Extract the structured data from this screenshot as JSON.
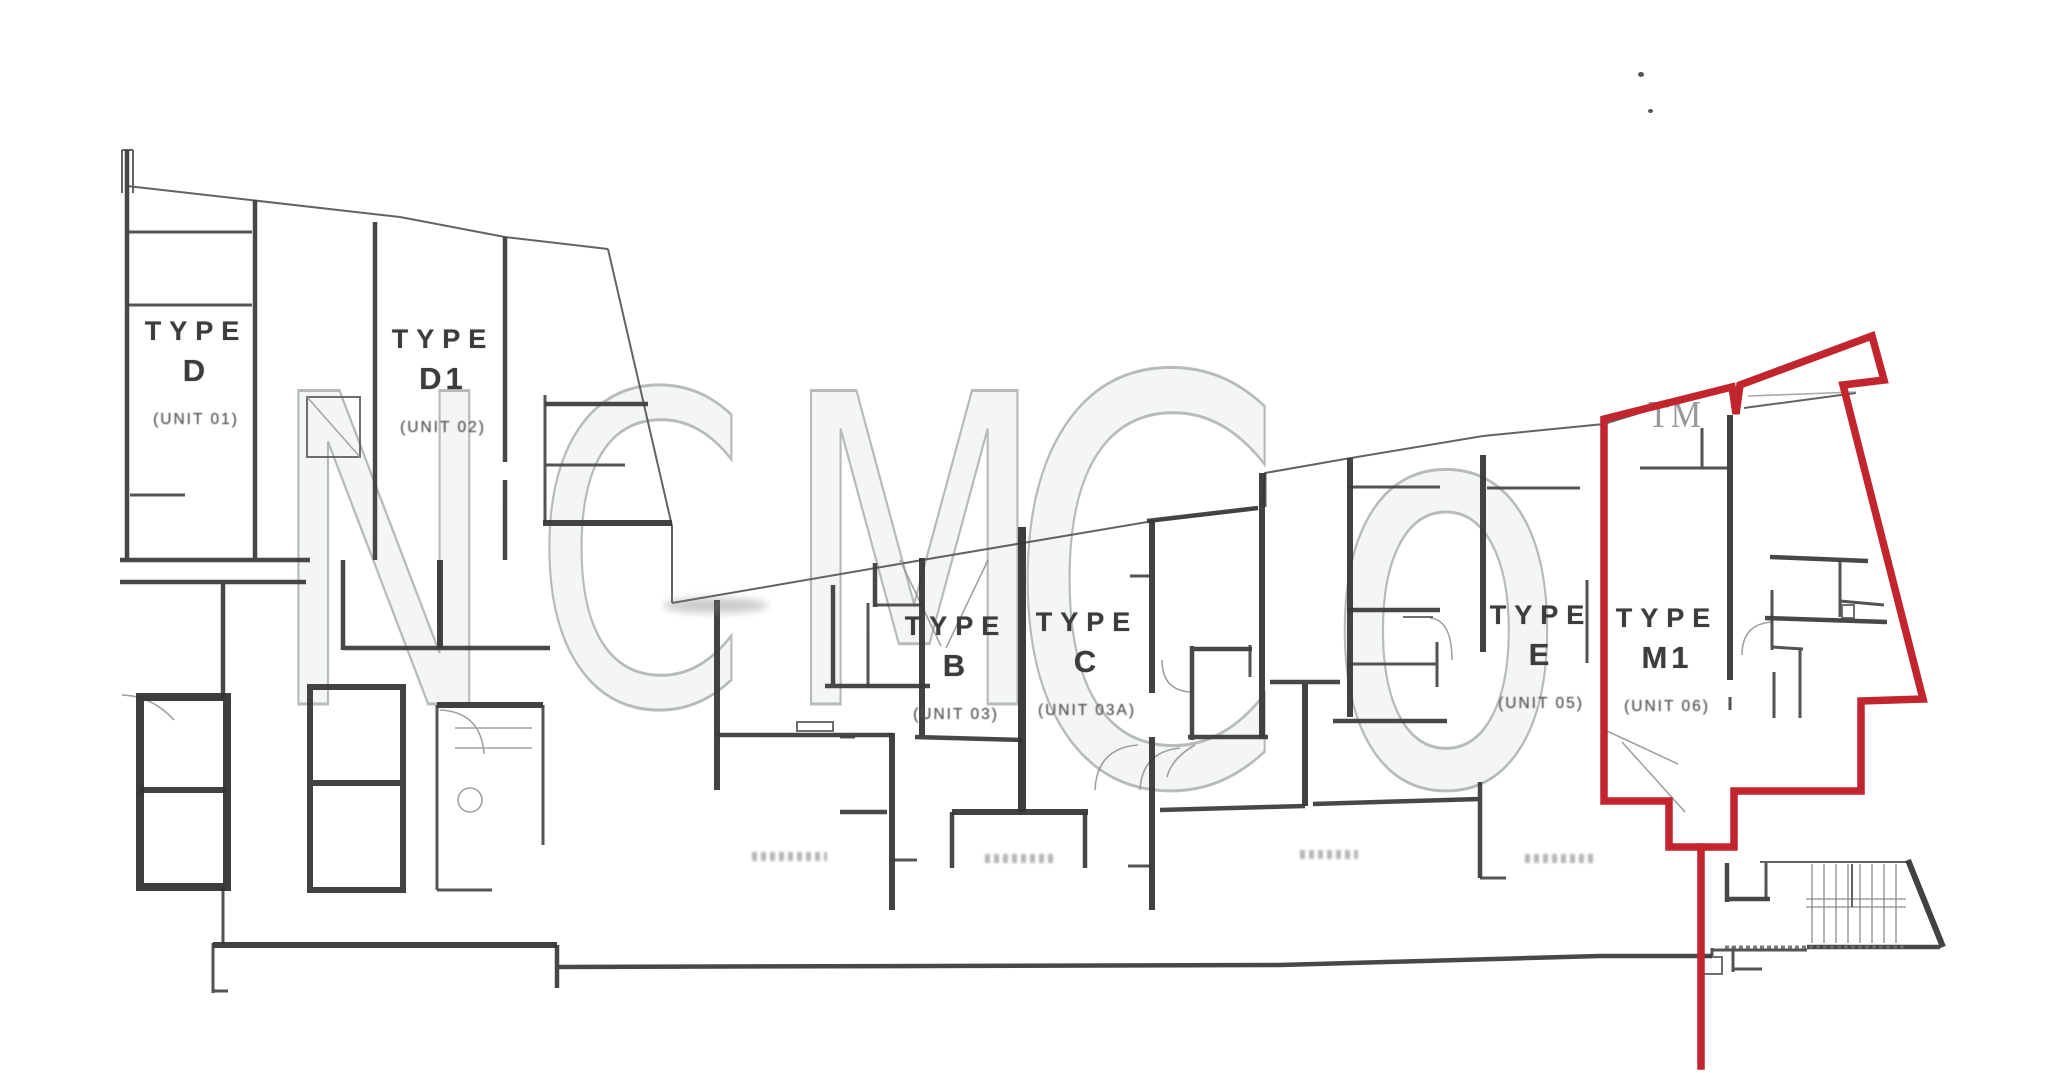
{
  "document": {
    "kind": "scanned apartment floor plan",
    "canvas": {
      "width": 2048,
      "height": 1073
    },
    "background_color": "#ffffff",
    "linework_color": "#3e3e3e"
  },
  "watermark": {
    "full_text": "NCM Co",
    "part1": "NCM",
    "part2": "Co",
    "trademark": "TM",
    "color": "#878d92"
  },
  "highlight": {
    "color": "#c3252e",
    "highlighted_unit": "TYPE M1 (UNIT 06)",
    "style": "thick red outline around unit M1 with pointer line to bottom edge"
  },
  "units": [
    {
      "key": "d",
      "type_word": "TYPE",
      "letter": "D",
      "unit": "(UNIT 01)",
      "highlighted": false
    },
    {
      "key": "d1",
      "type_word": "TYPE",
      "letter": "D1",
      "unit": "(UNIT 02)",
      "highlighted": false
    },
    {
      "key": "b",
      "type_word": "TYPE",
      "letter": "B",
      "unit": "(UNIT 03)",
      "highlighted": false
    },
    {
      "key": "c",
      "type_word": "TYPE",
      "letter": "C",
      "unit": "(UNIT 03A)",
      "highlighted": false
    },
    {
      "key": "e",
      "type_word": "TYPE",
      "letter": "E",
      "unit": "(UNIT 05)",
      "highlighted": false
    },
    {
      "key": "m1",
      "type_word": "TYPE",
      "letter": "M1",
      "unit": "(UNIT 06)",
      "highlighted": true
    }
  ]
}
